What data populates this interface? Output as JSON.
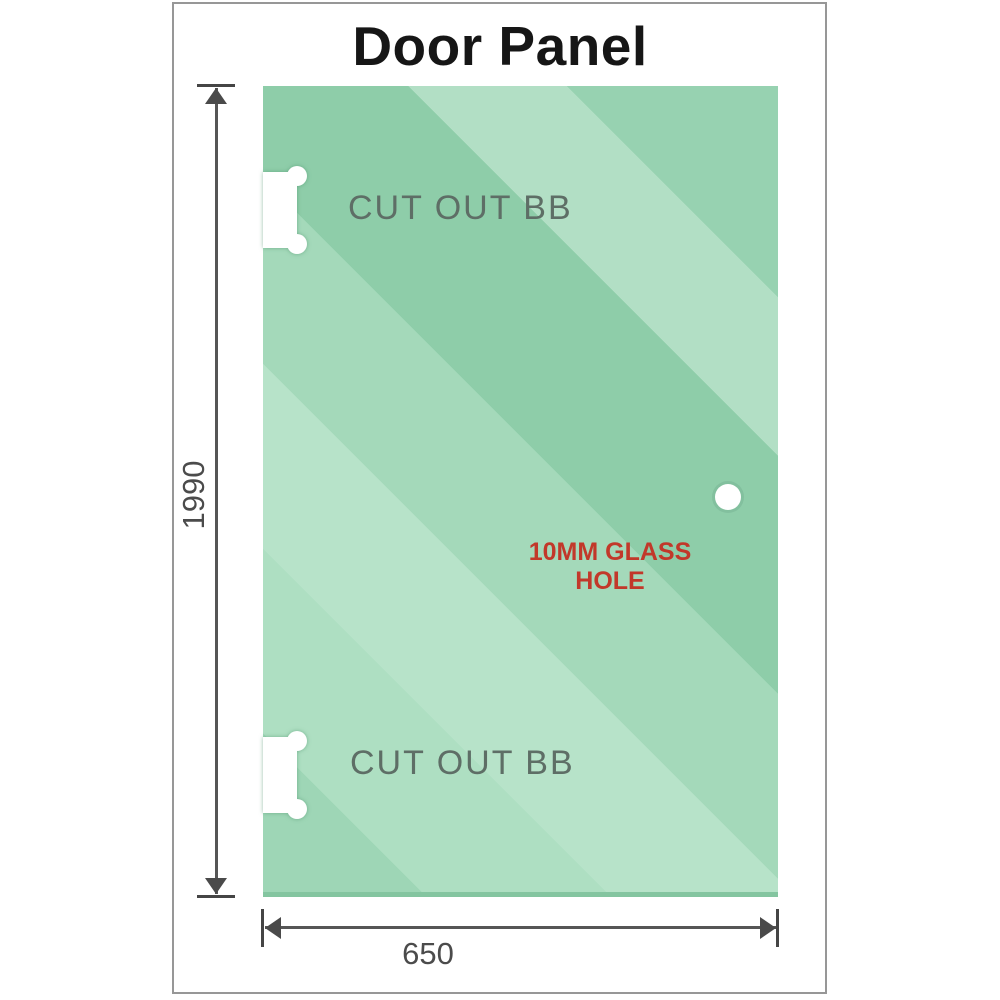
{
  "title": "Door Panel",
  "panel": {
    "cutouts": [
      {
        "label": "CUT OUT BB"
      },
      {
        "label": "CUT OUT BB"
      }
    ],
    "hole": {
      "label": "10MM GLASS HOLE"
    }
  },
  "dimensions": {
    "height": {
      "label": "1990"
    },
    "width": {
      "label": "650"
    }
  },
  "colors": {
    "glass_green_base": "#a4d9ba",
    "glass_green_dark": "#8ecda9",
    "glass_green_light": "#b7e3c9",
    "glass_bottom_edge": "#84c5a0",
    "hole_label_red": "#c2382a",
    "dimension_line_gray": "#565656",
    "cutout_label_gray": "#5e6e66",
    "frame_border_gray": "#979797",
    "title_color": "#161616"
  }
}
